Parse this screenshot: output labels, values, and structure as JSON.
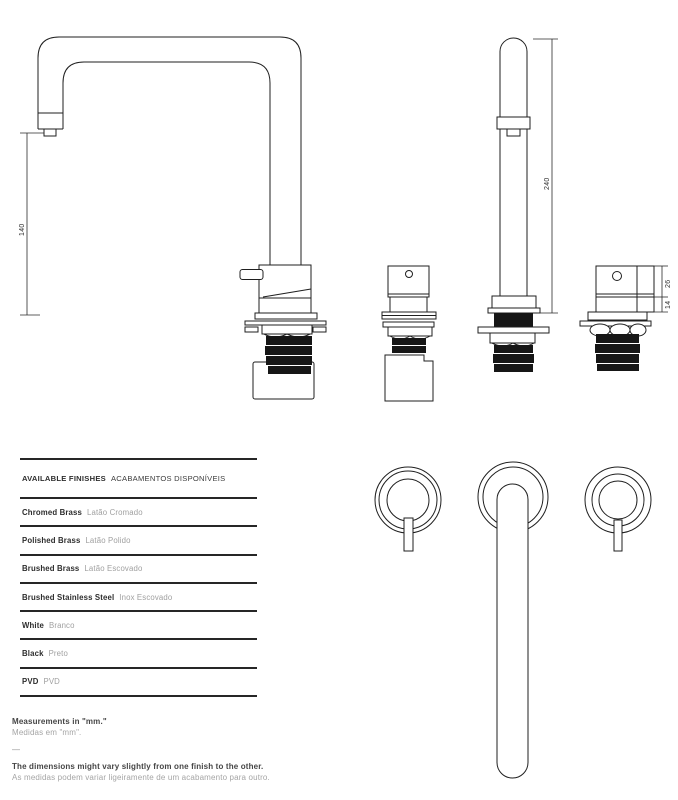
{
  "colors": {
    "line": "#1f1f1f",
    "text_dark": "#2d2d2d",
    "text_gray": "#a0a0a0"
  },
  "drawings": {
    "side_view": {
      "dimension_height": "140"
    },
    "front_view": {
      "dimension_height": "240"
    },
    "valve_right": {
      "dimension_top": "26",
      "dimension_bottom": "14"
    }
  },
  "finishes_table": {
    "header_en": "AVAILABLE FINISHES",
    "header_pt": "ACABAMENTOS DISPONÍVEIS",
    "rows": [
      {
        "en": "Chromed Brass",
        "pt": "Latão Cromado"
      },
      {
        "en": "Polished Brass",
        "pt": "Latão Polido"
      },
      {
        "en": "Brushed Brass",
        "pt": "Latão Escovado"
      },
      {
        "en": "Brushed Stainless Steel",
        "pt": "Inox Escovado"
      },
      {
        "en": "White",
        "pt": "Branco"
      },
      {
        "en": "Black",
        "pt": "Preto"
      },
      {
        "en": "PVD",
        "pt": "PVD"
      }
    ]
  },
  "notes": {
    "measurements_en": "Measurements in \"mm.\"",
    "measurements_pt": "Medidas em \"mm\".",
    "divider": "—",
    "variance_en": "The dimensions might vary slightly from one finish to the other.",
    "variance_pt": "As medidas podem variar ligeiramente de um acabamento para outro."
  }
}
